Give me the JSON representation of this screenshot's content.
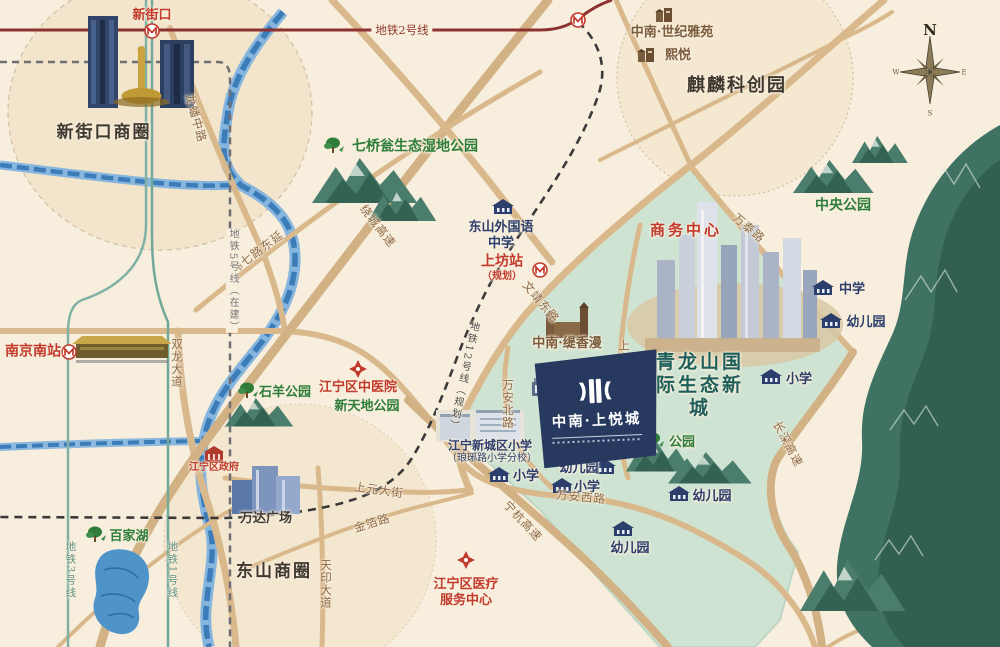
{
  "compass": {
    "n": "N",
    "e": "E",
    "s": "S",
    "w": "W"
  },
  "metro": {
    "line2_label": "地铁2号线",
    "line5_label": "地铁5号线（在建）",
    "line12_label": "地铁12号线（规划）",
    "line3_label": "地铁3号线",
    "line1_label": "地铁1号线"
  },
  "stations": {
    "xinjiekou": "新街口",
    "shangfang": "上坊站",
    "shangfang_note": "（规划）",
    "nanjing_south": "南京南站"
  },
  "districts": {
    "xinjiekou_cbd": "新街口商圈",
    "qilin_tech_park": "麒麟科创园",
    "dongshan_cbd": "东山商圈",
    "business_center": "商务中心",
    "qinglongshan_eco_city": "青龙山国际生态新城"
  },
  "roads": {
    "longpan_middle": "龙蟠中路",
    "raocheng_expwy": "绕城高速",
    "weiqi_east_ext": "纬七路东延",
    "shuanglong_ave": "双龙大道",
    "wenjing_east": "文靖东路",
    "wantai": "万泰路",
    "shanggao": "上高路",
    "wanan_north": "万安北路",
    "wanan_west": "万安西路",
    "ninghang_expwy": "宁杭高速",
    "changshen_expwy": "长深高速",
    "shangyuan_st": "上元大街",
    "jinbo": "金箔路",
    "tianyin_ave": "天印大道"
  },
  "parks": {
    "qiqiaoweng": "七桥瓮生态湿地公园",
    "central_park": "中央公园",
    "shiyang_park": "石羊公园",
    "xintiandi_park": "新天地公园",
    "baijia_lake": "百家湖",
    "park": "公园"
  },
  "education": {
    "dongshan_foreign_school": "东山外国语中学",
    "middle_school": "中学",
    "primary_school": "小学",
    "kindergarten": "幼儿园",
    "xincheng_primary": "江宁新城区小学",
    "xincheng_primary_branch": "（琅琊路小学分校）",
    "planning_hall": "新城规划馆"
  },
  "medical": {
    "tcm_hospital": "江宁区中医院",
    "medical_service_center": "江宁区医疗服务中心"
  },
  "government": {
    "jiangning_gov": "江宁区政府"
  },
  "projects": {
    "shangyuecheng": "中南·上悦城",
    "tixiangman": "中南·缇香漫",
    "shiji_yayuan": "中南·世纪雅苑",
    "xiyue": "熙悦",
    "wanda_plaza": "万达广场"
  },
  "colors": {
    "background": "#f8eedd",
    "eco_zone": "#cfe3d2",
    "road": "#d9b98c",
    "metro_line2": "#8e3131",
    "metro_line13": "#72a89a",
    "river": "#3c7cb8",
    "banner": "#27395f",
    "label_red": "#c23a2b",
    "label_green": "#2e7d3a",
    "label_navy": "#2c3e6b"
  }
}
